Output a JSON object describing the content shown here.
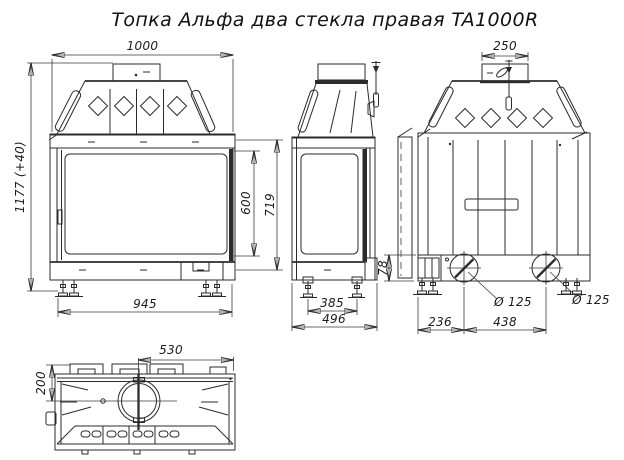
{
  "title": "Топка Альфа два стекла правая TA1000R",
  "drawing": {
    "front_view": {
      "dims": {
        "width": "1000",
        "height": "1177 (+40)",
        "glass_height": "600",
        "panel_height": "719",
        "feet_span": "945"
      }
    },
    "side_view": {
      "dims": {
        "feet_span": "385",
        "depth": "496"
      }
    },
    "rear_view": {
      "dims": {
        "collar_width": "250",
        "plenum_height": "78",
        "inlet_left": "Ø 125",
        "inlet_right": "Ø 125",
        "edge_to_inlet": "236",
        "inlet_spacing": "438"
      }
    },
    "top_view": {
      "dims": {
        "flue_to_edge": "530",
        "front_to_flue": "200"
      }
    }
  },
  "colors": {
    "line": "#2b2b2b",
    "background": "#ffffff"
  }
}
